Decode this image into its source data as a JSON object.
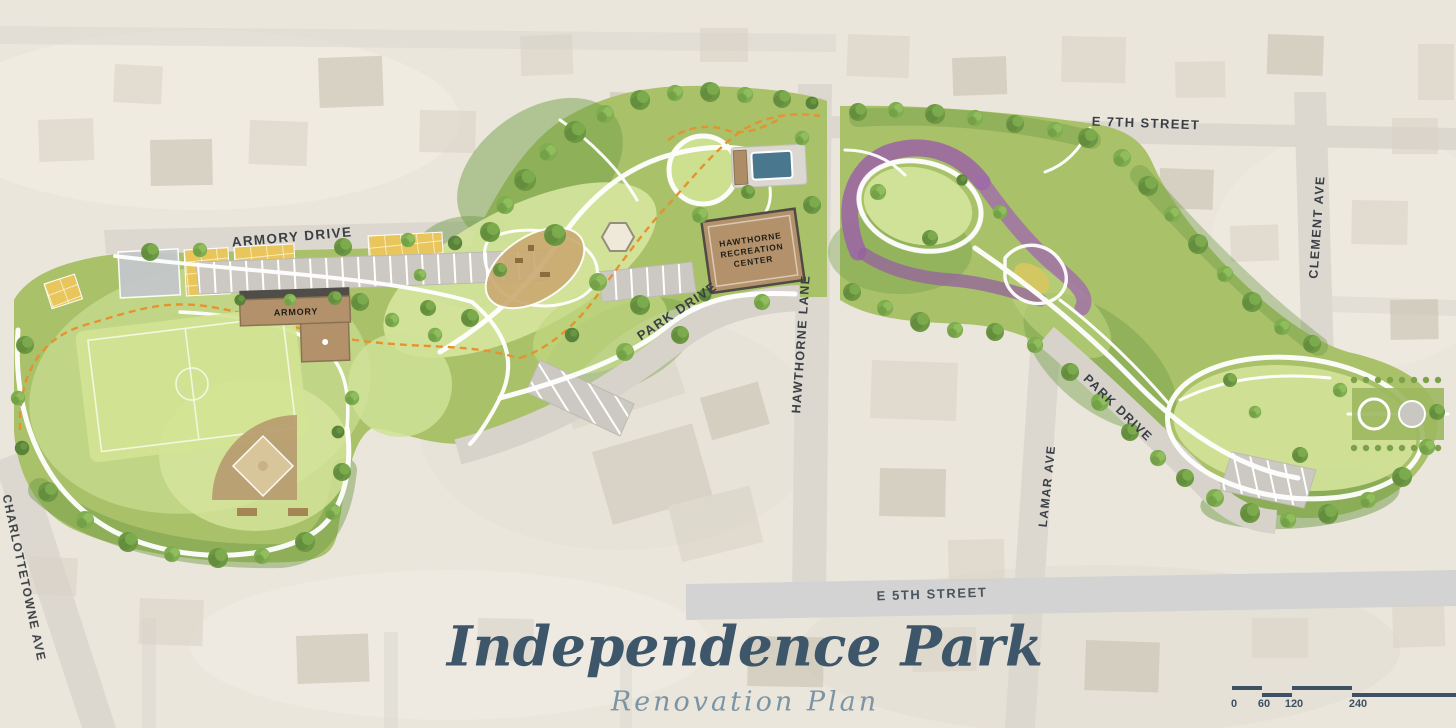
{
  "map": {
    "title": "Independence Park",
    "subtitle": "Renovation Plan",
    "streets": {
      "armory_drive": "ARMORY DRIVE",
      "e7th": "E 7TH STREET",
      "clement": "CLEMENT AVE",
      "park_drive_west": "PARK DRIVE",
      "hawthorne": "HAWTHORNE LANE",
      "lamar": "LAMAR AVE",
      "e5th": "E 5TH STREET",
      "charlottetowne": "CHARLOTTETOWNE AVE",
      "park_drive_east": "PARK DRIVE"
    },
    "buildings": {
      "armory": "ARMORY",
      "rec_center": "HAWTHORNE\nRECREATION\nCENTER"
    },
    "scale": {
      "t0": "0",
      "t1": "60",
      "t2": "120",
      "t3": "240"
    },
    "colors": {
      "title": "#3d566a",
      "street_label": "#3a3f45",
      "trail_orange": "#e5922f",
      "garden_purple": "#9b62a5",
      "park_green": "#a9c169",
      "pool_blue": "#49788e"
    }
  }
}
